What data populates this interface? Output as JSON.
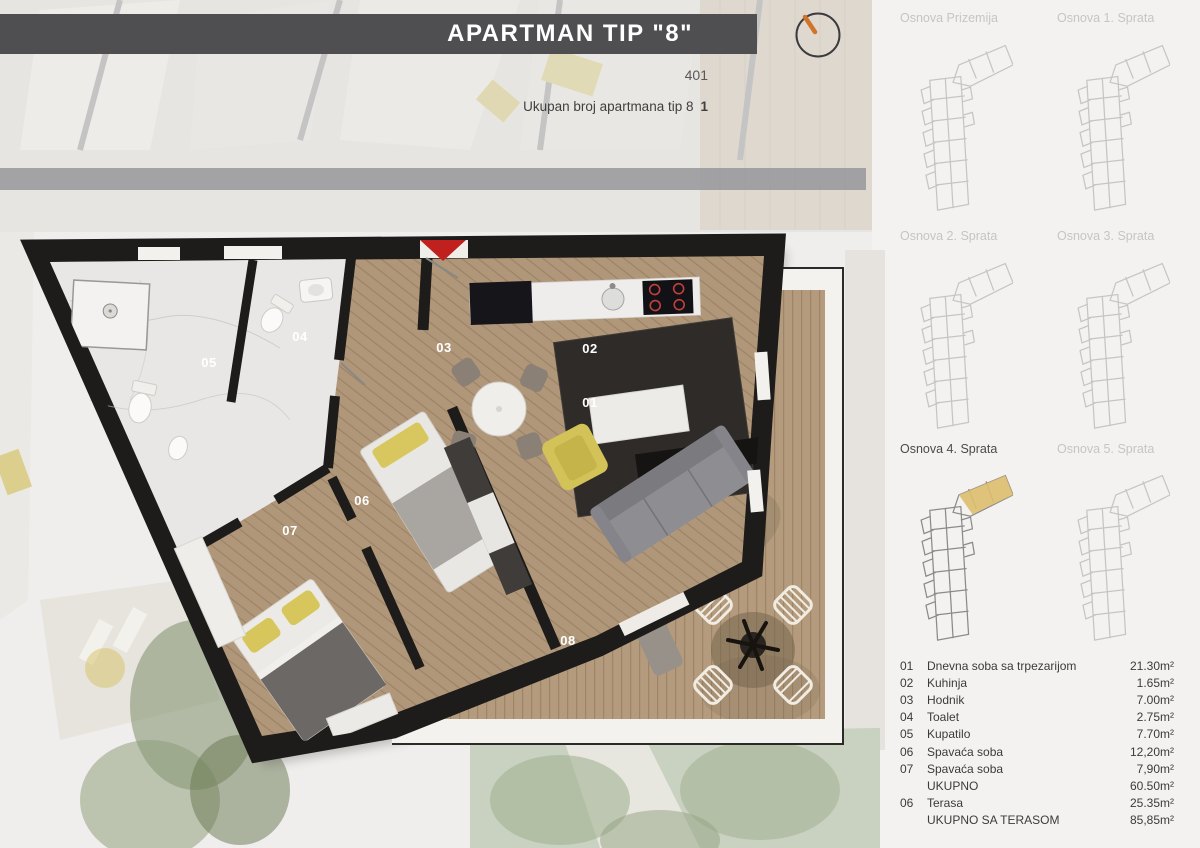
{
  "header": {
    "title": "APARTMAN TIP \"8\"",
    "unit_number": "401",
    "total_label": "Ukupan broj apartmana tip 8",
    "total_value": "1"
  },
  "icons": {
    "compass": "compass-dial-icon",
    "entrance_marker": "entrance-arrow-icon"
  },
  "colors": {
    "header_bar": "#4f4f51",
    "accent_red": "#c0201e",
    "highlight_yellow": "#ddbe6e",
    "wall_black": "#1d1c1a",
    "wood_interior": "#b19779",
    "wood_deck": "#b49b7d",
    "compass_needle": "#d0742a"
  },
  "plan": {
    "rooms": [
      {
        "label": "01"
      },
      {
        "label": "02"
      },
      {
        "label": "03"
      },
      {
        "label": "04"
      },
      {
        "label": "05"
      },
      {
        "label": "06"
      },
      {
        "label": "07"
      },
      {
        "label": "08"
      }
    ]
  },
  "thumbnails": [
    {
      "label": "Osnova Prizemija",
      "active": false
    },
    {
      "label": "Osnova 1. Sprata",
      "active": false
    },
    {
      "label": "Osnova 2. Sprata",
      "active": false
    },
    {
      "label": "Osnova 3. Sprata",
      "active": false
    },
    {
      "label": "Osnova 4. Sprata",
      "active": true
    },
    {
      "label": "Osnova 5. Sprata",
      "active": false
    }
  ],
  "legend": {
    "rows": [
      {
        "num": "01",
        "name": "Dnevna soba sa trpezarijom",
        "area": "21.30m²"
      },
      {
        "num": "02",
        "name": "Kuhinja",
        "area": "1.65m²"
      },
      {
        "num": "03",
        "name": "Hodnik",
        "area": "7.00m²"
      },
      {
        "num": "04",
        "name": "Toalet",
        "area": "2.75m²"
      },
      {
        "num": "05",
        "name": "Kupatilo",
        "area": "7.70m²"
      },
      {
        "num": "06",
        "name": "Spavaća soba",
        "area": "12,20m²"
      },
      {
        "num": "07",
        "name": "Spavaća soba",
        "area": "7,90m²"
      },
      {
        "num": "",
        "name": "UKUPNO",
        "area": "60.50m²"
      },
      {
        "num": "06",
        "name": "Terasa",
        "area": "25.35m²"
      },
      {
        "num": "",
        "name": "UKUPNO SA TERASOM",
        "area": "85,85m²"
      }
    ]
  }
}
